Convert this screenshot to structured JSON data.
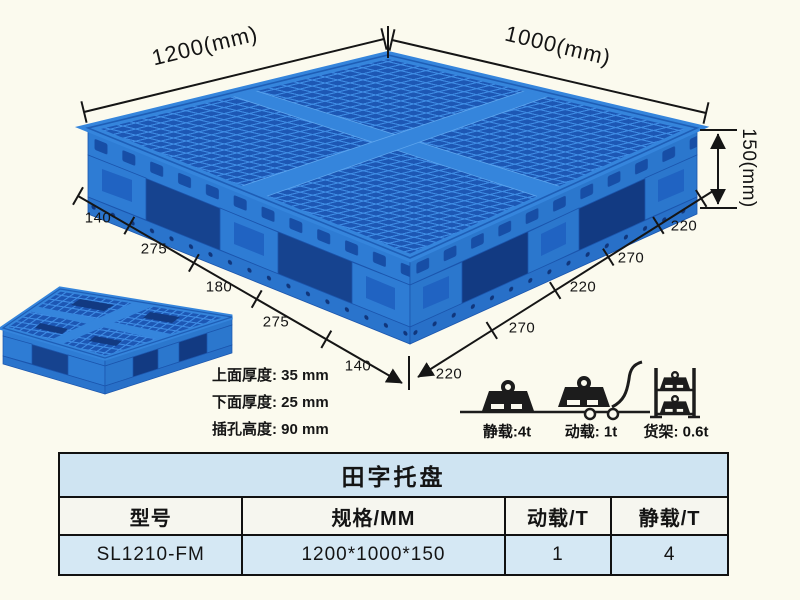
{
  "product": {
    "dimensions": {
      "edge_left_total": "1200(mm)",
      "edge_right_total": "1000(mm)",
      "height_total": "150(mm)",
      "left_edge_segments": [
        "140",
        "275",
        "180",
        "275",
        "140"
      ],
      "right_edge_segments": [
        "220",
        "270",
        "220",
        "270",
        "220"
      ]
    },
    "thickness_notes": [
      "上面厚度: 35 mm",
      "下面厚度: 25 mm",
      "插孔高度: 90 mm"
    ],
    "load_ratings": [
      {
        "icon": "static-load-weight-icon",
        "label": "静载:4t"
      },
      {
        "icon": "dynamic-load-trolley-icon",
        "label": "动载: 1t"
      },
      {
        "icon": "rack-load-shelf-icon",
        "label": "货架: 0.6t"
      }
    ]
  },
  "spec_table": {
    "title": "田字托盘",
    "headers": [
      "型号",
      "规格/MM",
      "动载/T",
      "静载/T"
    ],
    "row": [
      "SL1210-FM",
      "1200*1000*150",
      "1",
      "4"
    ]
  },
  "colors": {
    "background": "#fbfaee",
    "pallet_primary": "#2e7cd4",
    "pallet_dark": "#16438f",
    "mesh_rib": "#3e8ce4",
    "mesh_hole": "#1d57b4",
    "table_title_bg": "#cfe4f2",
    "table_data_bg": "#d5e8f4",
    "annotation": "#141414"
  }
}
